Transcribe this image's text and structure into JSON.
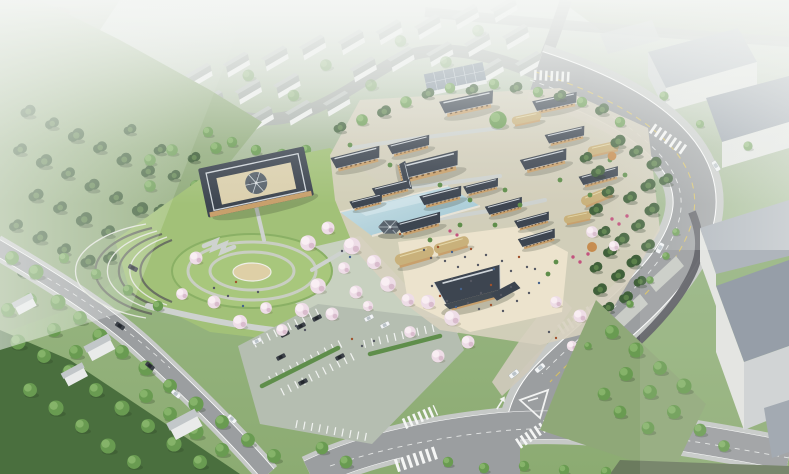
{
  "image": {
    "title": "Aerial rendering of a traditional Korean hanok culture park",
    "description": "Bird's-eye architectural rendering: a hanok village with dark tiled roofs and thatched houses around a reflecting pond and sandy visitor plaza, a square courtyard building with a round central pavilion, a circular great lawn with amphitheater terraces, blooming cherry trees, a landscaped parking lot, curved arterial roads with crosswalks and cars, hazy white residential blocks behind and gray industrial warehouses to the right."
  },
  "scene": {
    "landmarks": {
      "hanok_village": "Hanok building complex with tiled and thatched roofs",
      "courtyard_building": "Square courtyard building with round central pavilion",
      "pond": "Rectangular reflecting pond with hexagonal pavilion",
      "plaza": "Sandy event plaza crowded with visitors",
      "lawn": "Circular great lawn with ring paths and amphitheater terraces",
      "cherry": "Cherry blossom grove in bloom",
      "parking": "Landscaped surface parking lot with cars",
      "roads": "Curved arterial road, local streets, crosswalks and vehicles",
      "background": "Hazy white residential blocks and gray warehouses"
    }
  },
  "colors": {
    "haze": "#f3f5f3",
    "roof": "#3d4550",
    "ridge": "#cfd5da",
    "wallTan": "#c8a06c",
    "wallDark": "#6f5335",
    "thatch": "#c9b17b",
    "thatchRidge": "#e4d7a8",
    "court": "#dbd0ae",
    "pavRoof": "#5a646d",
    "pond": "#a9ccd6",
    "pondLight": "#cfe3e8",
    "plaza": "#ece3cd",
    "stone": "#d7d0bf",
    "parkGrass": "#a2c178",
    "lawn": "#a8c77c",
    "grassDark": "#8ab065",
    "bgGrass": "#aebfa0",
    "hillGreen": "#93ad7e",
    "slope": "#8fa878",
    "forest": "#4a6f3e",
    "pine": "#40603a",
    "pineLight": "#5b8049",
    "tree": "#699b51",
    "treeLight": "#85b369",
    "cherry": "#eedde7",
    "cherryLight": "#f9eef3",
    "cherryShade": "#d9bccd",
    "autumn": "#c58a4c",
    "road": "#9b9ea0",
    "sidewalk": "#c6c9c7",
    "sidewalkWarm": "#cfc9ba",
    "curb": "#ffffff",
    "laneYellow": "#ddc35c",
    "darkWall": "#585a60",
    "walk": "#ced2cf",
    "parking": "#b5beb1",
    "hedge": "#5f8e4b",
    "whRoof": "#8c95a0",
    "whRoofLight": "#a7aeb6",
    "whWall": "#e2e4e0",
    "whWallShade": "#cdd1d2",
    "bgHouseRoof": "#a9b0ab",
    "bgHouseRoofLight": "#c2c8c4",
    "bgHouseWall": "#eef0ee",
    "solarRoof": "#8593a0",
    "solarLine": "#c6d0d8",
    "carDark": "#3c4148",
    "carWhite": "#f3f5f6",
    "flower": "#c2537e",
    "people": "#555863"
  }
}
